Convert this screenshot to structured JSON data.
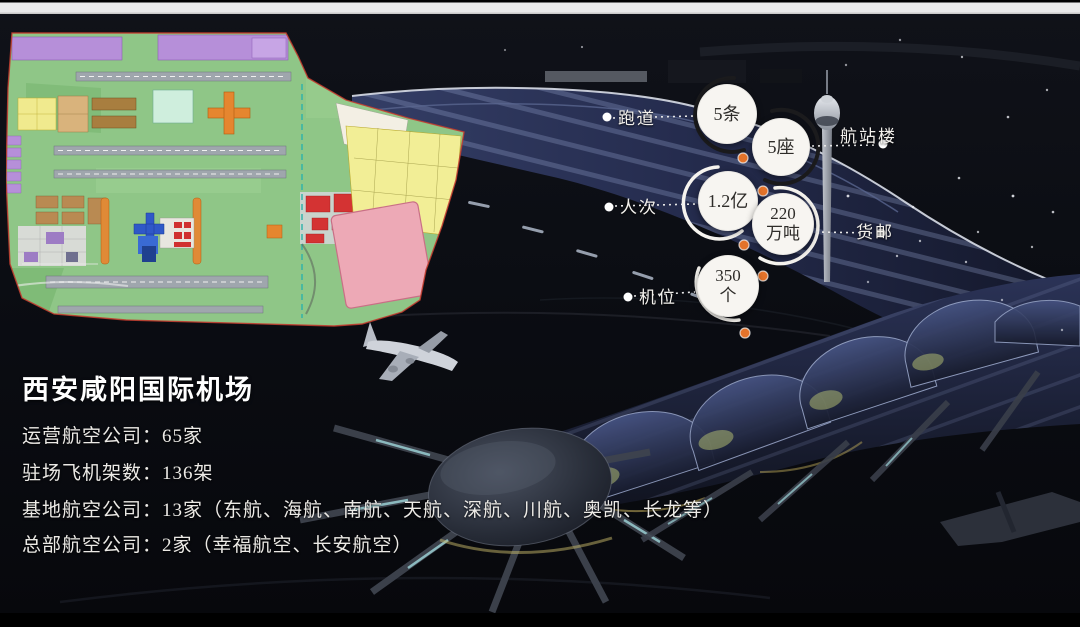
{
  "slide": {
    "title": "西安咸阳国际机场",
    "facts": [
      "运营航空公司：65家",
      "驻场飞机架数：136架",
      "基地航空公司：13家（东航、海航、南航、天航、深航、川航、奥凯、长龙等）",
      "总部航空公司：2家（幸福航空、长安航空）"
    ]
  },
  "callouts": {
    "runways": {
      "label": "跑道",
      "value_line1": "5条",
      "value_line2": ""
    },
    "terminals": {
      "label": "航站楼",
      "value_line1": "5座",
      "value_line2": ""
    },
    "passengers": {
      "label": "人次",
      "value_line1": "1.2亿",
      "value_line2": ""
    },
    "cargo": {
      "label": "货邮",
      "value_line1": "220",
      "value_line2": "万吨"
    },
    "stands": {
      "label": "机位",
      "value_line1": "350",
      "value_line2": "个"
    }
  },
  "colors": {
    "accent_orange": "#e4732a",
    "circle_fill": "#f7f5f1",
    "label_text": "#f2f0ec",
    "title_text": "#ffffff"
  }
}
